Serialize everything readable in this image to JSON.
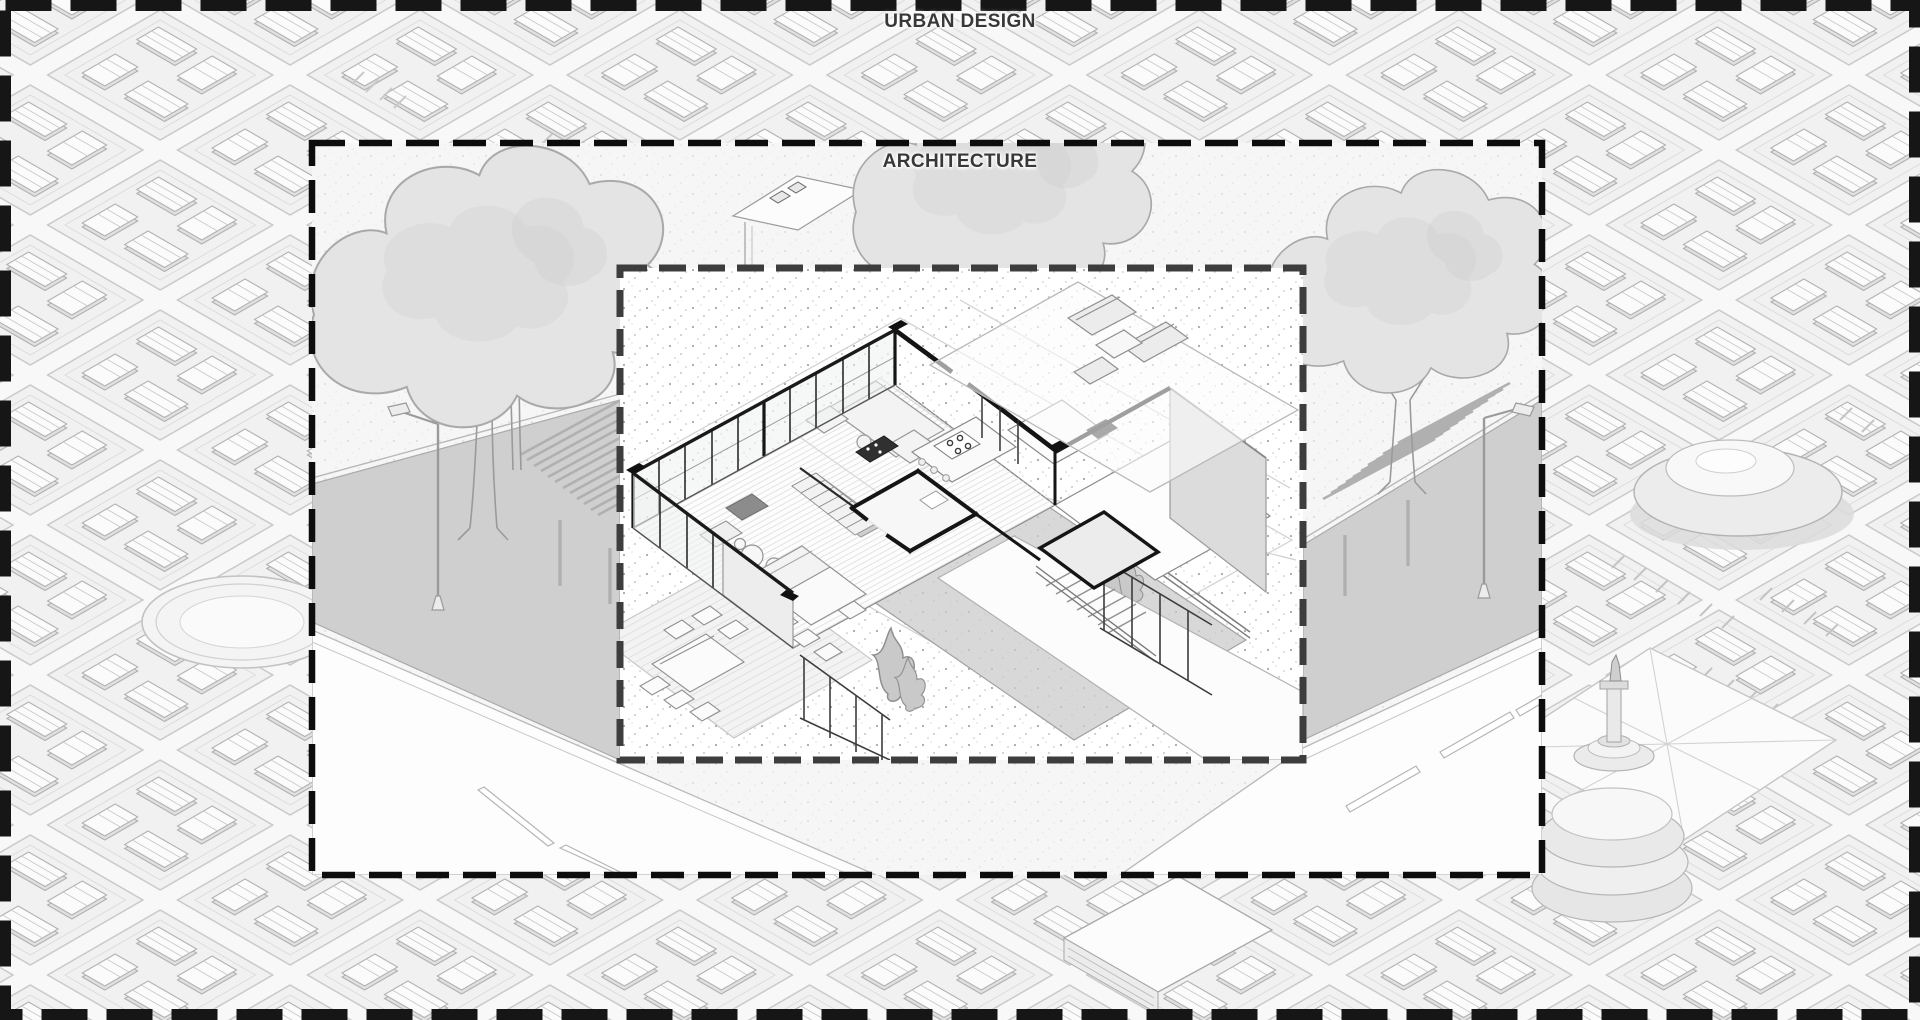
{
  "illustration": {
    "outer_frame": {
      "label": "URBAN DESIGN"
    },
    "middle_frame": {
      "label": "ARCHITECTURE"
    },
    "inner_frame": {
      "description": "isometric house interior cutaway vignette"
    }
  },
  "colors": {
    "outer_border": "#161616",
    "middle_border": "#0d0d0d",
    "inner_border": "#3d3d3d",
    "label_text": "#383838",
    "site_ground": "#f6f6f6",
    "city_street": "#f8f8f8",
    "city_block": "#f1f1f1",
    "tree_fill": "#e4e4e4",
    "tree_outline": "#a9a9a9",
    "walkway_gray": "#cfcfcf",
    "road_white": "#fdfdfd",
    "house_wall": "#161616",
    "furniture_fill": "#f1f1f1",
    "stipple_dot": "#a8a8a8"
  }
}
